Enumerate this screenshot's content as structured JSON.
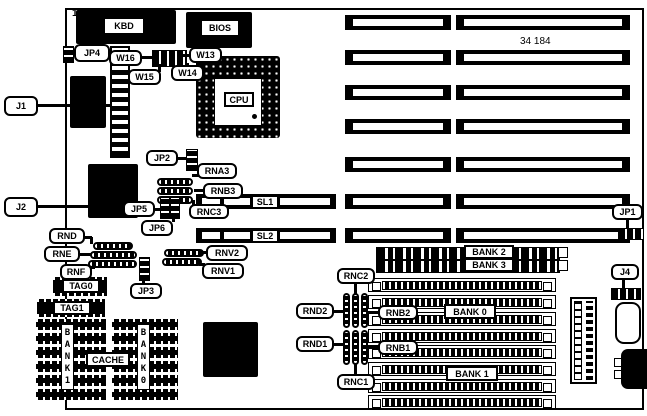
{
  "figure": {
    "pin_label": "11",
    "board_id": "34 184"
  },
  "chips": {
    "kbd": "KBD",
    "bios": "BIOS",
    "cpu": "CPU"
  },
  "connectors": {
    "j1": "J1",
    "j2": "J2",
    "j4": "J4"
  },
  "jumpers": {
    "jp1": "JP1",
    "jp2": "JP2",
    "jp3": "JP3",
    "jp4": "JP4",
    "jp5": "JP5",
    "jp6": "JP6",
    "w13": "W13",
    "w14": "W14",
    "w15": "W15",
    "w16": "W16"
  },
  "resistor_networks": {
    "rna3": "RNA3",
    "rnb3": "RNB3",
    "rnc3": "RNC3",
    "rnd": "RND",
    "rne": "RNE",
    "rnf": "RNF",
    "rnv1": "RNV1",
    "rnv2": "RNV2",
    "rnb1": "RNB1",
    "rnb2": "RNB2",
    "rnc1": "RNC1",
    "rnc2": "RNC2",
    "rnd1": "RND1",
    "rnd2": "RND2"
  },
  "slots": {
    "sl1": "SL1",
    "sl2": "SL2"
  },
  "memory": {
    "bank0": "BANK 0",
    "bank1": "BANK 1",
    "bank2": "BANK 2",
    "bank3": "BANK 3"
  },
  "cache": {
    "label": "CACHE",
    "tag0": "TAG0",
    "tag1": "TAG1",
    "bank0_column": "BANK0",
    "bank1_column": "BANK1"
  }
}
